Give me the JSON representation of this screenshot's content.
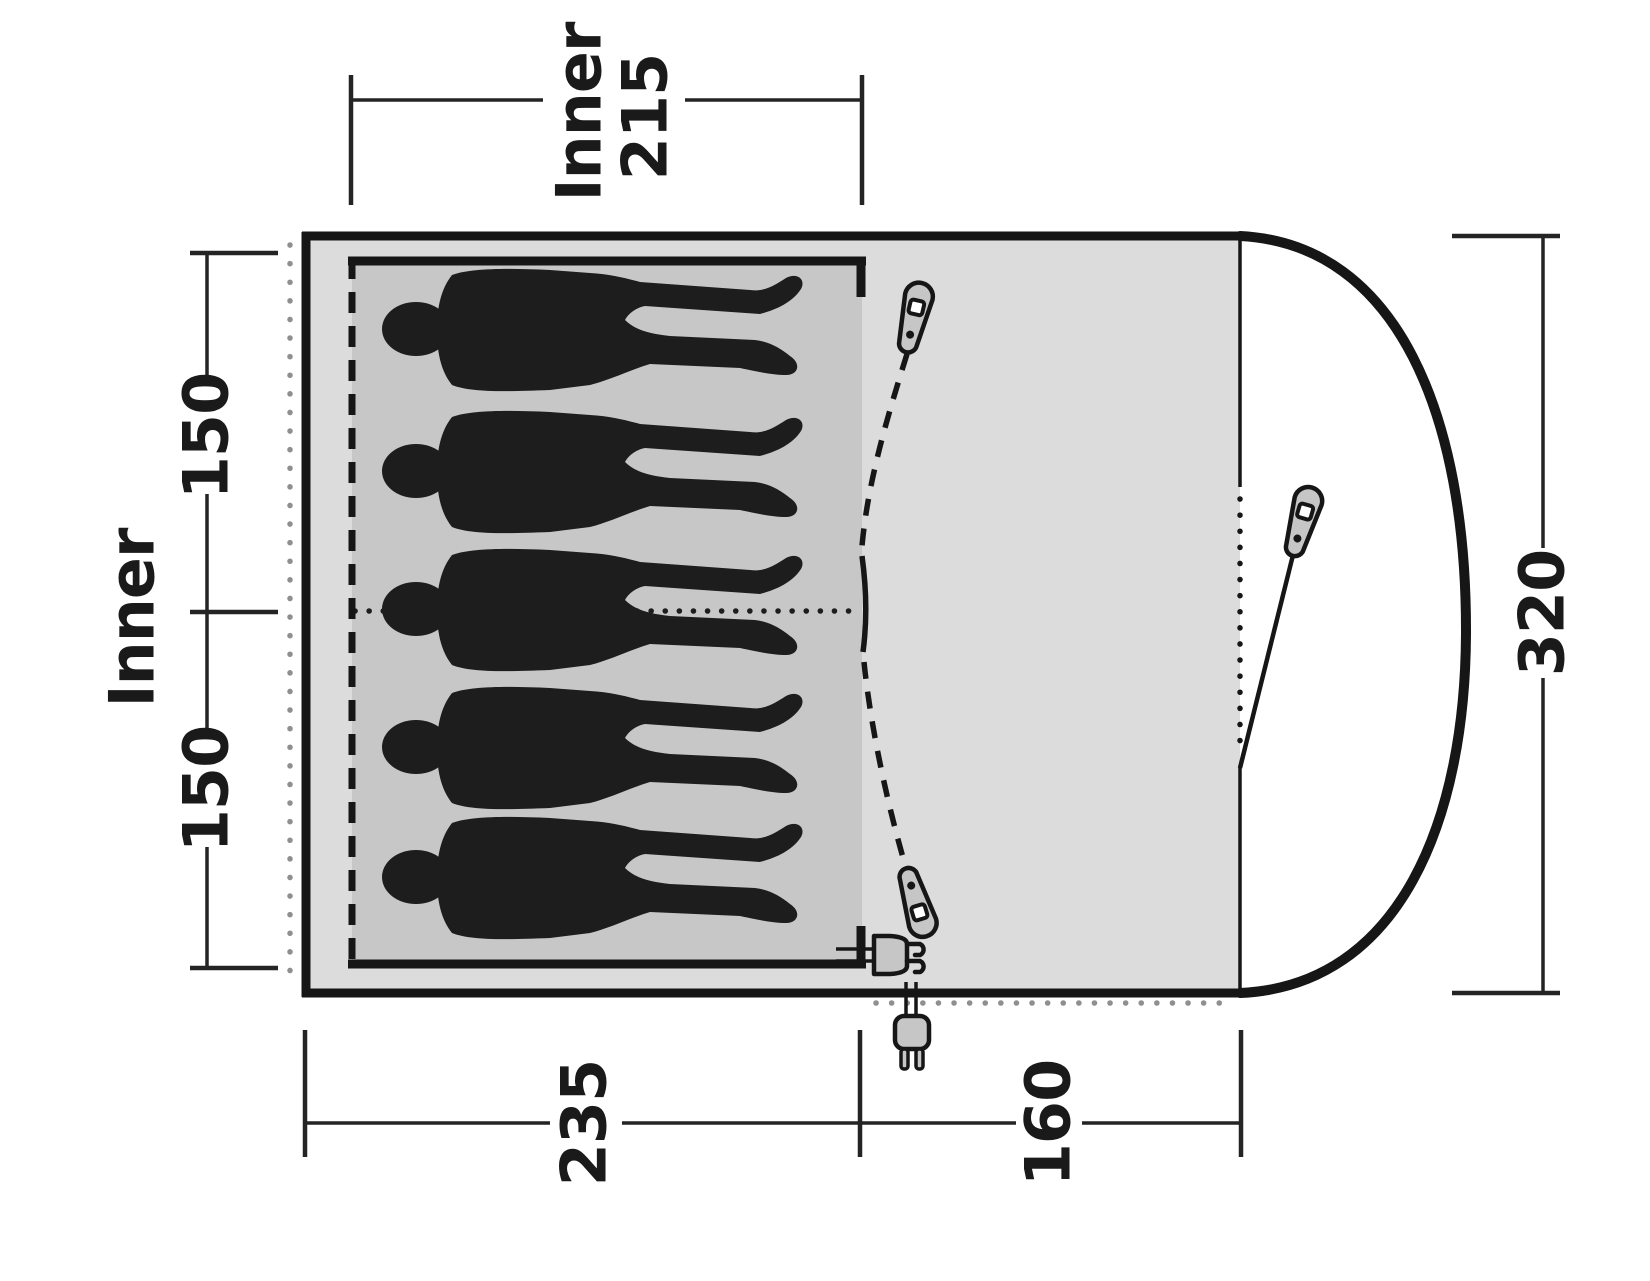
{
  "diagram": {
    "type": "tent-floorplan-top-view",
    "capacity_persons": 5,
    "dimensions": {
      "top_inner_width": {
        "line1": "Inner",
        "line2": "215"
      },
      "left": {
        "area_label": "Inner",
        "upper_section": "150",
        "lower_section": "150"
      },
      "right": {
        "total_depth": "320"
      },
      "bottom": {
        "sleeping_section": "235",
        "porch_section": "160"
      }
    },
    "colors": {
      "outline": "#161616",
      "body_fill": "#dcdcdc",
      "inner_tent_fill": "#c7c7c7",
      "porch_fill": "#ffffff",
      "silhouette": "#1d1d1d",
      "hardware_fill": "#c6c6c6",
      "guide_dots": "#8f8f8f",
      "dimension_lines": "#242424"
    }
  }
}
